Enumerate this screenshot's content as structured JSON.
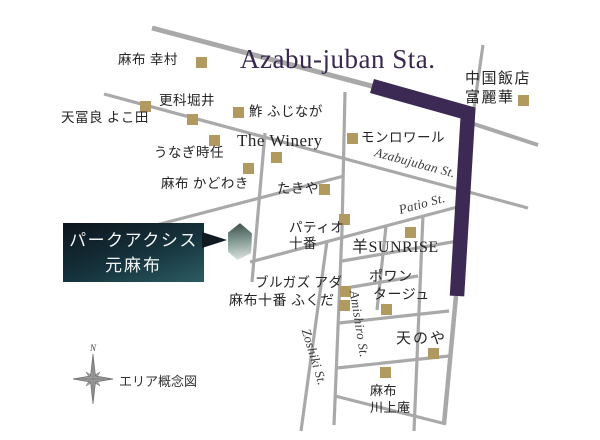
{
  "map": {
    "station_title": "Azabu-juban Sta.",
    "legend_caption": "エリア概念図",
    "compass_north_label": "N",
    "property": {
      "name_line1": "パークアクシス",
      "name_line2": "元麻布"
    },
    "street_names": {
      "azabujuban": "Azabujuban St.",
      "patio": "Patio St.",
      "amishiro": "Amishiro St.",
      "zoshiki": "Zoshiki St."
    },
    "places": {
      "yukimura": "麻布 幸村",
      "sarashina_horii": "更科堀井",
      "tempura_yokota": "天冨良 よこ田",
      "sushi_fujinaga": "鮓 ふじなが",
      "the_winery": "The Winery",
      "unagi_tokito": "うなぎ時任",
      "monloire": "モンロワール",
      "azabu_kadowaki": "麻布 かどわき",
      "takiya": "たきや",
      "patio_juban_line1": "パティオ",
      "patio_juban_line2": "十番",
      "hitsuji_sunrise": "羊SUNRISE",
      "chugoku_hanten_line1": "中国飯店",
      "chugoku_hanten_line2": "富麗華",
      "bulgaz_ada": "ブルガズ アダ",
      "azabujuban_fukuda": "麻布十番 ふくだ",
      "pointage_line1": "ポワン",
      "pointage_line2": "タージュ",
      "amanoya": "天のや",
      "kawakamian_line1": "麻布",
      "kawakamian_line2": "川上庵"
    },
    "colors": {
      "route_highlight": "#3c2a54",
      "street_gray": "#a9a9a9",
      "marker_gold": "#b19a5f",
      "station_title_color": "#392750"
    }
  }
}
